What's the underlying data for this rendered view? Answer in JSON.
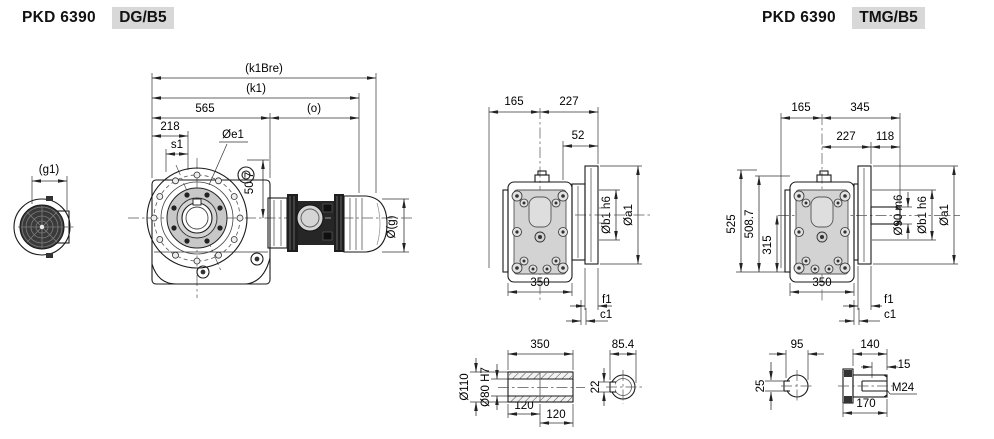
{
  "colors": {
    "line": "#1a1a1a",
    "fill_light": "#d9d9d9",
    "fill_dark": "#222222",
    "badge": "#d8d8d8"
  },
  "dg": {
    "title_model": "PKD 6390",
    "title_variant": "DG/B5",
    "side": {
      "g1": "(g1)",
      "k1bre": "(k1Bre)",
      "k1": "(k1)",
      "d565": "565",
      "o": "(o)",
      "d218": "218",
      "s1": "s1",
      "oe1": "Øe1",
      "d50_7": "50.7",
      "og": "Ø(g)"
    },
    "rear": {
      "d165": "165",
      "d227": "227",
      "d52": "52",
      "ob1": "Øb1 h6",
      "oa1": "Øa1",
      "d350": "350",
      "f1": "f1",
      "c1": "c1"
    },
    "shaft": {
      "d350": "350",
      "o110": "Ø110",
      "o80": "Ø80 H7",
      "d120a": "120",
      "d120b": "120",
      "d85_4": "85.4",
      "d22": "22"
    }
  },
  "tmg": {
    "title_model": "PKD 6390",
    "title_variant": "TMG/B5",
    "rear": {
      "d165": "165",
      "d345": "345",
      "d227": "227",
      "d118": "118",
      "d525": "525",
      "d508_7": "508.7",
      "d315": "315",
      "o90": "Ø90 m6",
      "ob1": "Øb1 h6",
      "oa1": "Øa1",
      "d350": "350",
      "f1": "f1",
      "c1": "c1"
    },
    "shaft": {
      "d95": "95",
      "d25": "25",
      "d140": "140",
      "d15": "15",
      "m24": "M24",
      "d170": "170"
    }
  }
}
